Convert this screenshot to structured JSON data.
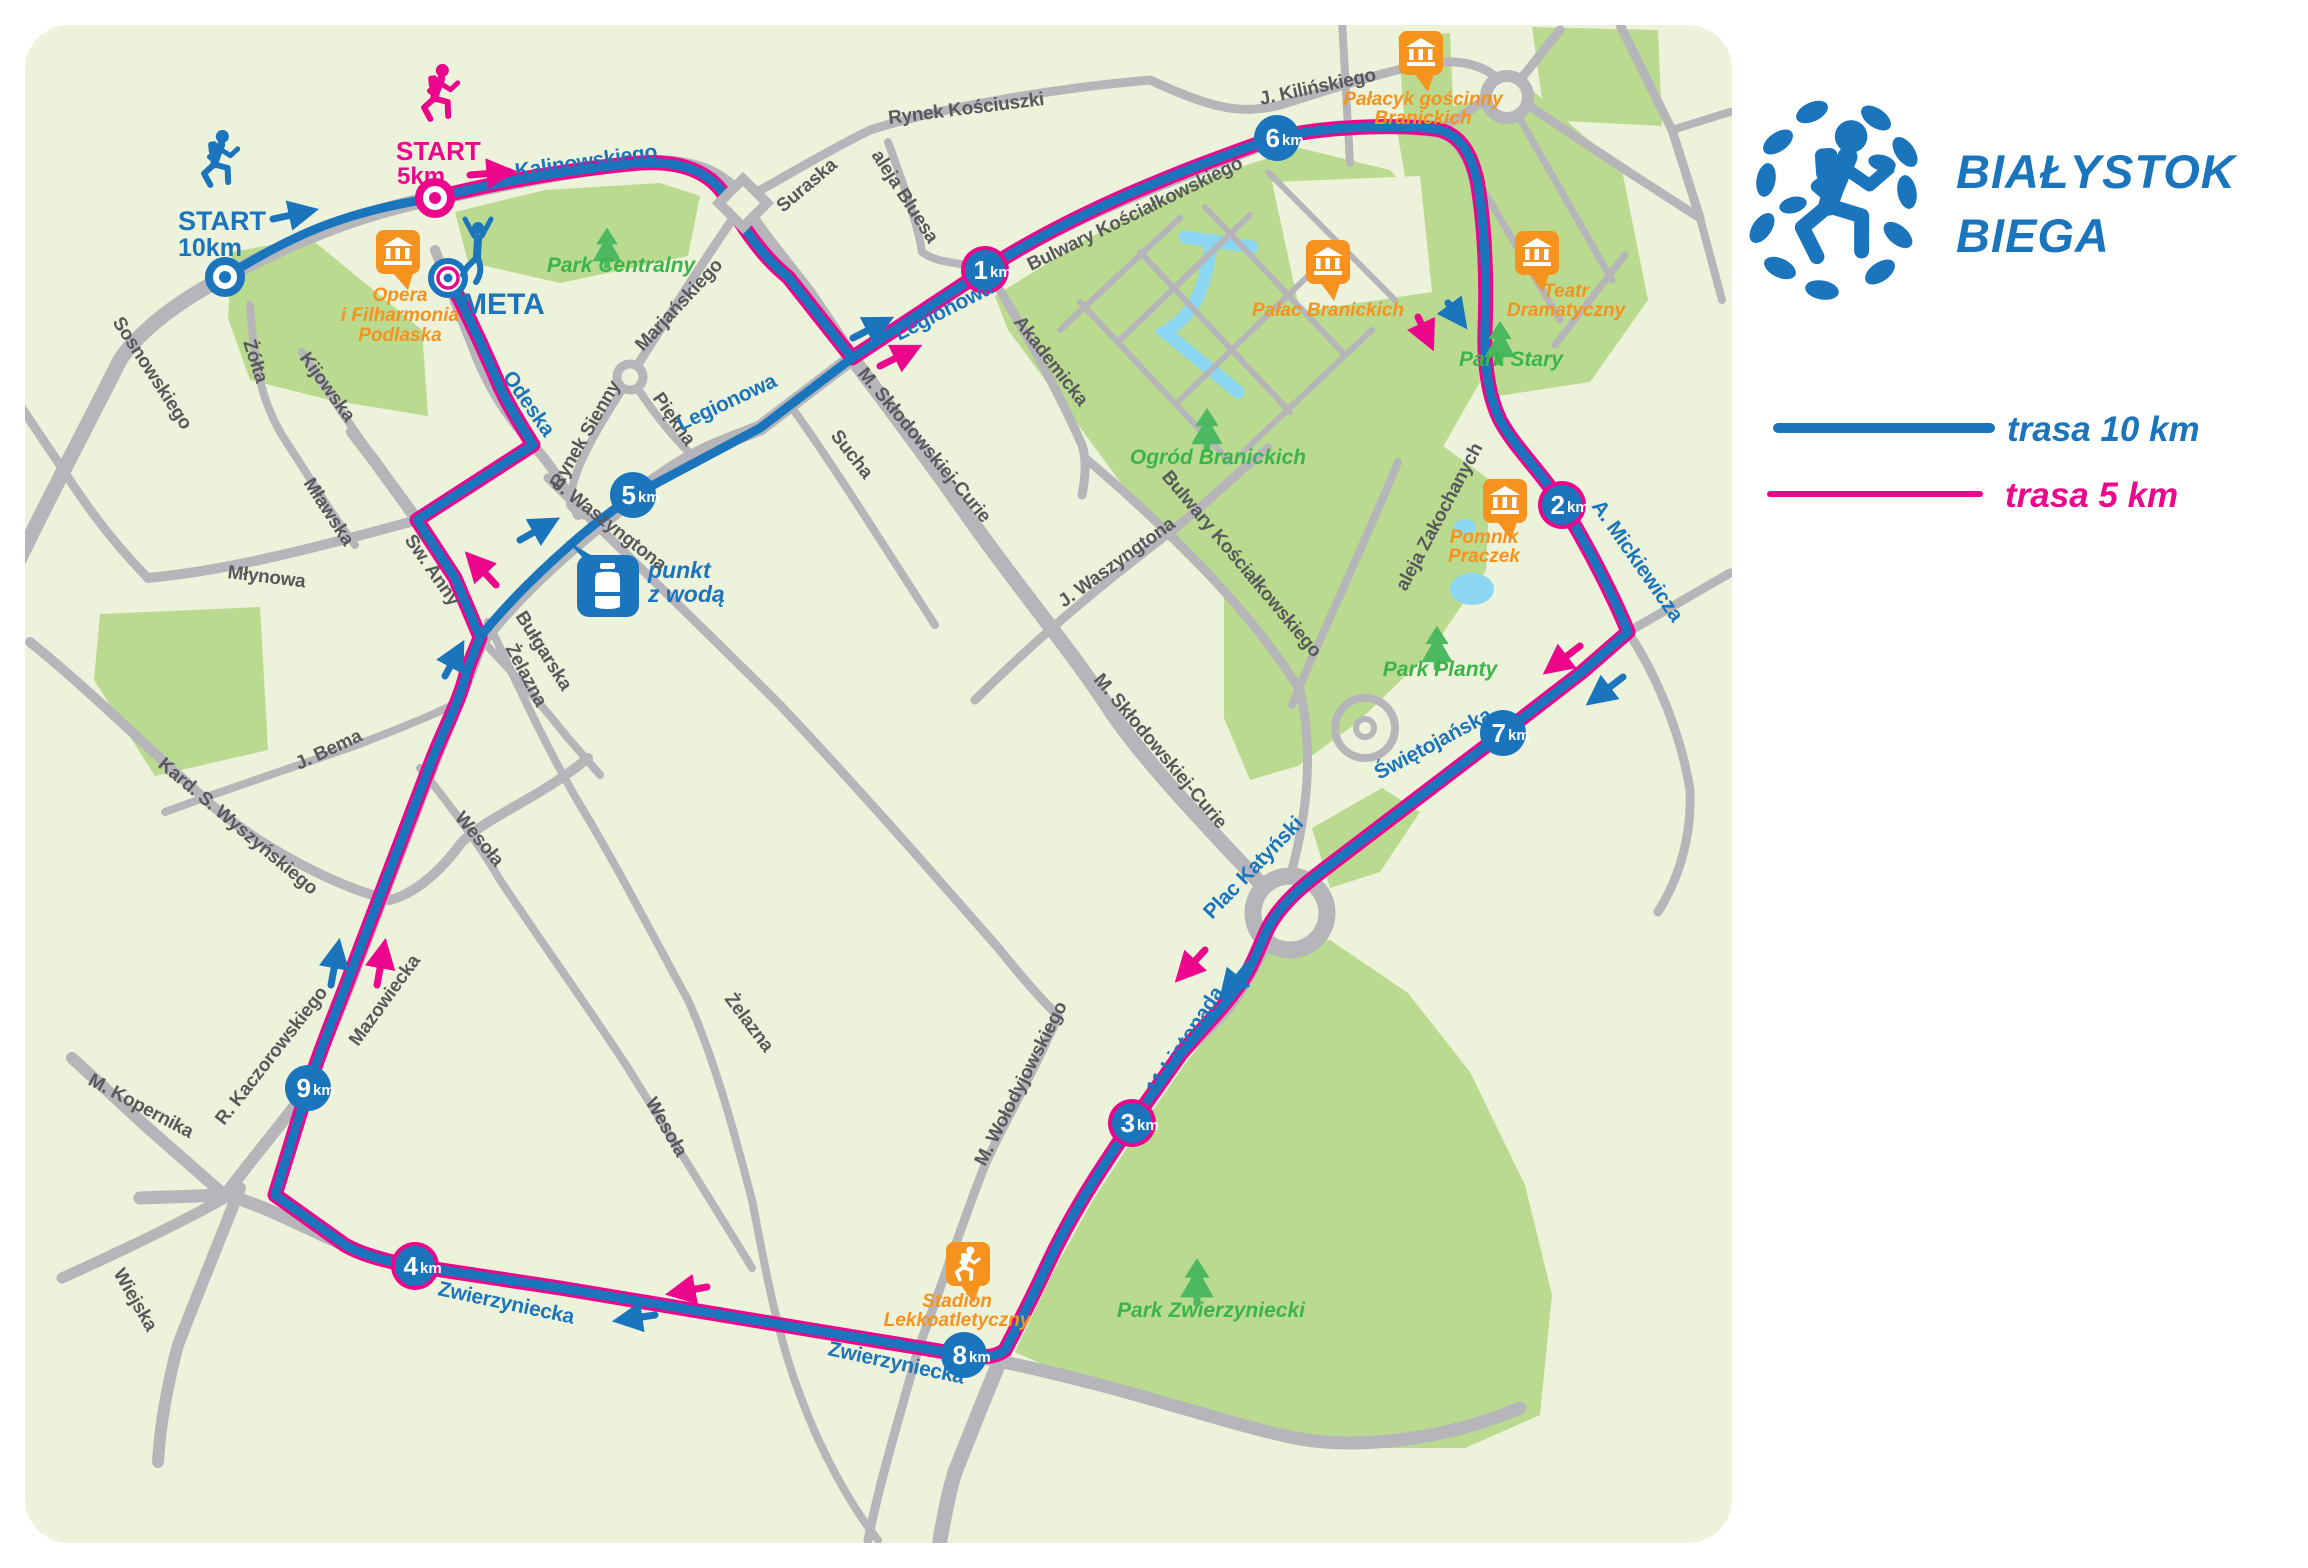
{
  "logo": {
    "line1": "BIAŁYSTOK",
    "line2": "BIEGA"
  },
  "legend": {
    "items": [
      {
        "label": "trasa 10 km",
        "color": "#1b75bc"
      },
      {
        "label": "trasa 5 km",
        "color": "#ec068c"
      }
    ]
  },
  "colors": {
    "route_10km": "#1b75bc",
    "route_5km": "#ec068c",
    "poi_orange": "#f6921e",
    "park_green": "#bada90",
    "park_text": "#3bb54a",
    "road_gray": "#b5b5ba",
    "map_bg": "#edf2da",
    "water": "#8bd7f3"
  },
  "markers": {
    "start10": {
      "line1": "START",
      "line2": "10km"
    },
    "start5": {
      "line1": "START",
      "line2": "5km"
    },
    "meta": "META",
    "water_point": {
      "line1": "punkt",
      "line2": "z wodą"
    }
  },
  "km_markers": [
    {
      "n": "1",
      "u": "km"
    },
    {
      "n": "2",
      "u": "km"
    },
    {
      "n": "3",
      "u": "km"
    },
    {
      "n": "4",
      "u": "km"
    },
    {
      "n": "5",
      "u": "km"
    },
    {
      "n": "6",
      "u": "km"
    },
    {
      "n": "7",
      "u": "km"
    },
    {
      "n": "8",
      "u": "km"
    },
    {
      "n": "9",
      "u": "km"
    }
  ],
  "streets_blue": [
    "Kalinowskiego",
    "Legionowa",
    "Legionowa",
    "Odeska",
    "A. Mickiewicza",
    "Świętojańska",
    "Plac Katyński",
    "11 Listopada",
    "Zwierzyniecka",
    "Zwierzyniecka"
  ],
  "streets_gray": [
    "Sosnowskiego",
    "Żółta",
    "Kijowska",
    "Mławska",
    "Młynowa",
    "Św. Anny",
    "Rynek Sienny",
    "Piękna",
    "Marjańskiego",
    "Suraska",
    "Rynek Kościuszki",
    "aleja Bluesa",
    "J. Kilińskiego",
    "Bulwary Kościałkowskiego",
    "Akademicka",
    "M. Skłodowskiej-Curie",
    "Sucha",
    "J. Waszyngtona",
    "J. Waszyngtona",
    "M. Skłodowskiej-Curie",
    "Bulwary Kościałkowskiego",
    "aleja Zakochanych",
    "M. Wołodyjowskiego",
    "Żelazna",
    "Żelazna",
    "Wesoła",
    "Wesoła",
    "Bułgarska",
    "Mazowiecka",
    "R. Kaczorowskiego",
    "Kard. S. Wyszyńskiego",
    "J. Bema",
    "M. Kopernika",
    "Wiejska"
  ],
  "parks": [
    "Park Centralny",
    "Ogród Branickich",
    "Park Stary",
    "Park Planty",
    "Park Zwierzyniecki"
  ],
  "pois": {
    "opera": {
      "lines": [
        "Opera",
        "i Filharmonia",
        "Podlaska"
      ]
    },
    "palacyk": {
      "lines": [
        "Pałacyk gościnny",
        "Branickich"
      ]
    },
    "palac": {
      "lines": [
        "Pałac Branickich"
      ]
    },
    "teatr": {
      "lines": [
        "Teatr",
        "Dramatyczny"
      ]
    },
    "pomnik": {
      "lines": [
        "Pomnik",
        "Praczek"
      ]
    },
    "stadion": {
      "lines": [
        "Stadion",
        "Lekkoatletyczny"
      ]
    }
  }
}
